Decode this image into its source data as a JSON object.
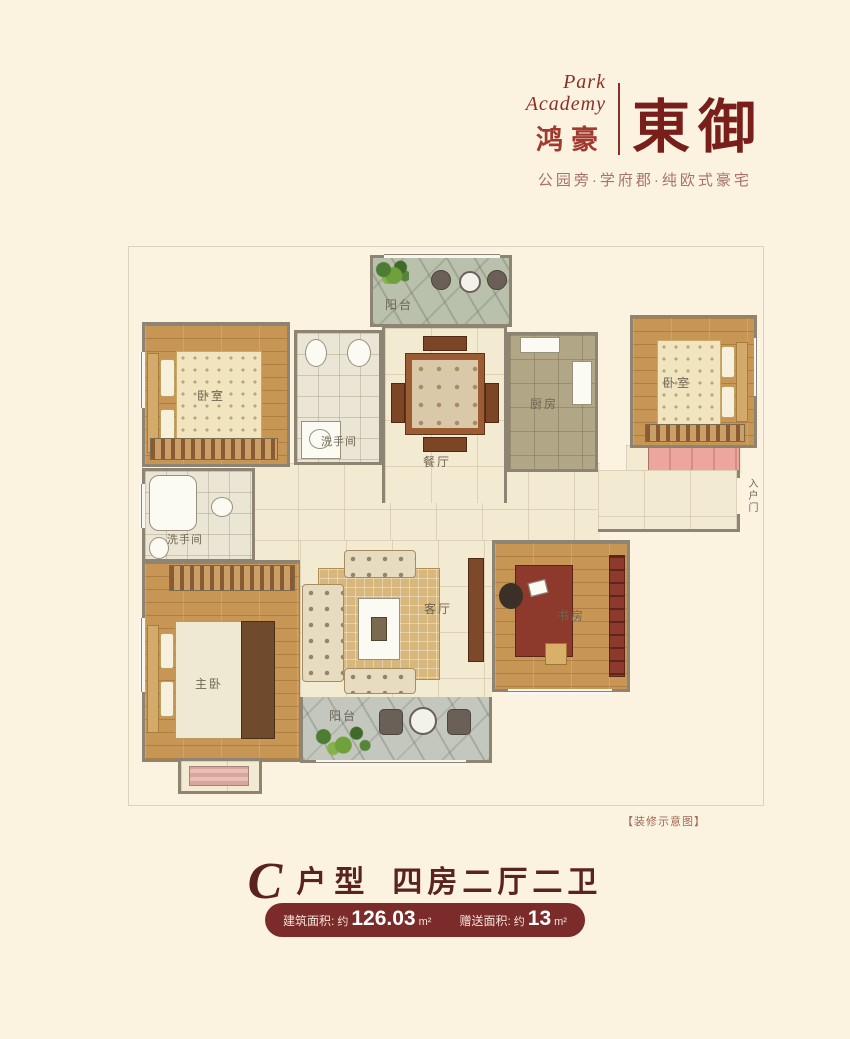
{
  "page": {
    "background": "#fbf3e0"
  },
  "logo": {
    "brand_en_line1": "Park",
    "brand_en_line2": "Academy",
    "brand_cn": "鸿豪",
    "project_name": "東御",
    "tagline": "公园旁·学府郡·纯欧式豪宅",
    "accent_color": "#8c2f27"
  },
  "floorplan": {
    "rooms": [
      {
        "id": "balcony-top",
        "label": "阳台"
      },
      {
        "id": "bedroom-top-left",
        "label": "卧室"
      },
      {
        "id": "bathroom-top",
        "label": "洗手间"
      },
      {
        "id": "dining",
        "label": "餐厅"
      },
      {
        "id": "kitchen",
        "label": "厨房"
      },
      {
        "id": "bedroom-top-right",
        "label": "卧室"
      },
      {
        "id": "bathroom-left",
        "label": "洗手间"
      },
      {
        "id": "living",
        "label": "客厅"
      },
      {
        "id": "study",
        "label": "书房"
      },
      {
        "id": "master-bedroom",
        "label": "主卧"
      },
      {
        "id": "balcony-bottom",
        "label": "阳台"
      }
    ],
    "entry_door_label": "入户门",
    "disclaimer": "【装修示意图】"
  },
  "footer": {
    "unit_letter": "C",
    "unit_word": "户型",
    "unit_layout": "四房二厅二卫",
    "badge": {
      "background": "#7b2b29",
      "items": [
        {
          "label": "建筑面积:",
          "prefix": "约",
          "number": "126.03",
          "unit": "m²"
        },
        {
          "label": "赠送面积:",
          "prefix": "约",
          "number": "13",
          "unit": "m²"
        }
      ]
    }
  }
}
